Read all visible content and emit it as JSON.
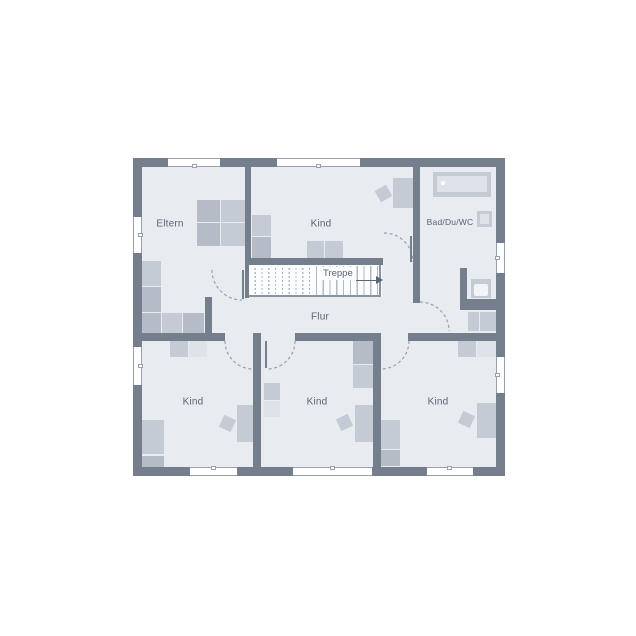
{
  "floor_plan": {
    "labels": {
      "eltern": "Eltern",
      "kind_top": "Kind",
      "bad": "Bad/Du/WC",
      "treppe": "Treppe",
      "flur": "Flur",
      "kind_bottom_left": "Kind",
      "kind_bottom_middle": "Kind",
      "kind_bottom_right": "Kind"
    },
    "stair_direction": "right",
    "colors": {
      "background": "#ffffff",
      "wall": "#747e8c",
      "floor": "#e8ebf0",
      "stair_floor": "#fbfcfd",
      "furniture": "#c5cbd5",
      "furniture_dark": "#b5bcc8",
      "furniture_light": "#dfe3e9",
      "line": "#97a0ad",
      "stair_line": "#b3bac4",
      "text": "#5a6472"
    }
  }
}
